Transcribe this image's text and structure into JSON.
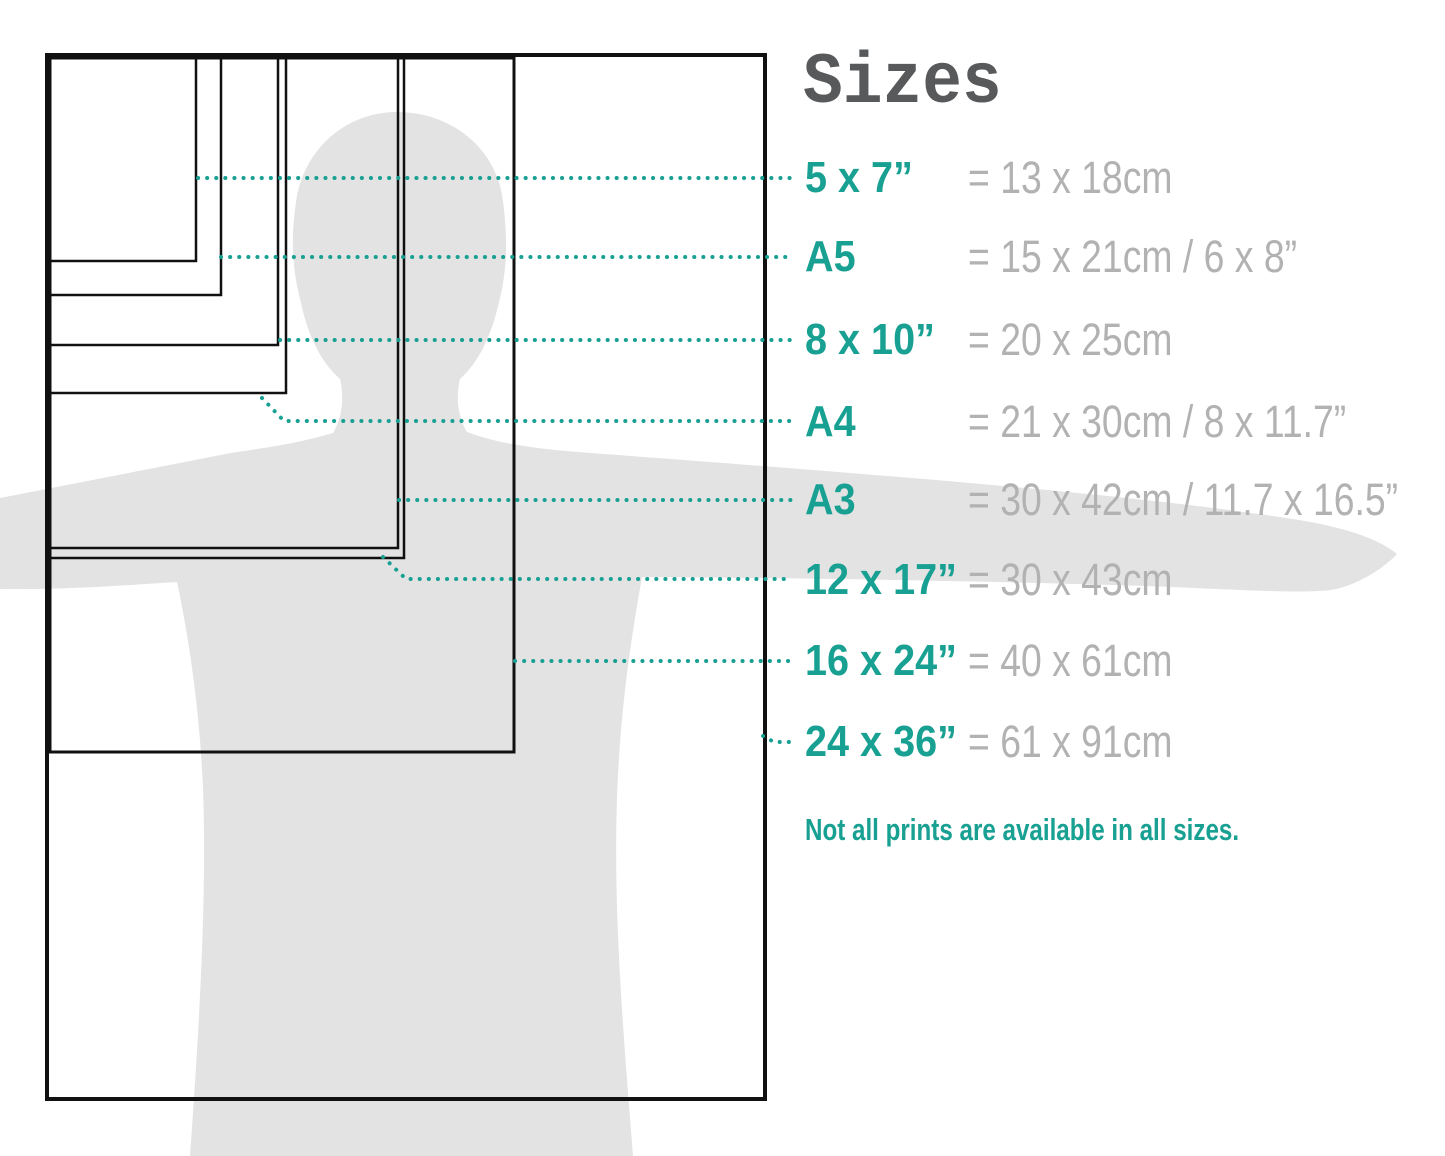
{
  "title": "Sizes",
  "note": "Not all prints are available in all sizes.",
  "colors": {
    "accent": "#18a092",
    "gray_text": "#b2b2b2",
    "title": "#58595b",
    "silhouette": "#e3e3e3",
    "border": "#111111"
  },
  "sizes": {
    "rows": [
      {
        "label": "5 x 7”",
        "metric": "= 13 x 18cm"
      },
      {
        "label": "A5",
        "metric": "= 15 x 21cm / 6 x 8”"
      },
      {
        "label": "8 x 10”",
        "metric": "= 20 x 25cm"
      },
      {
        "label": "A4",
        "metric": "= 21 x 30cm / 8 x 11.7”"
      },
      {
        "label": "A3",
        "metric": "= 30 x 42cm / 11.7 x 16.5”"
      },
      {
        "label": "12 x 17”",
        "metric": "= 30 x 43cm"
      },
      {
        "label": "16 x 24”",
        "metric": "= 40 x 61cm"
      },
      {
        "label": "24 x 36”",
        "metric": "= 61 x 91cm"
      }
    ]
  },
  "diagram": {
    "rects": [
      {
        "name": "24x36",
        "x": 47,
        "y": 55,
        "w": 718,
        "h": 1044,
        "sw": 4
      },
      {
        "name": "16x24",
        "x": 50,
        "y": 58,
        "w": 464,
        "h": 694,
        "sw": 3
      },
      {
        "name": "12x17",
        "x": 50,
        "y": 58,
        "w": 354,
        "h": 500,
        "sw": 2.5
      },
      {
        "name": "A3",
        "x": 50,
        "y": 58,
        "w": 348,
        "h": 490,
        "sw": 2.5
      },
      {
        "name": "A4",
        "x": 50,
        "y": 58,
        "w": 236,
        "h": 335,
        "sw": 2.5
      },
      {
        "name": "8x10",
        "x": 50,
        "y": 58,
        "w": 228,
        "h": 287,
        "sw": 2.5
      },
      {
        "name": "A5",
        "x": 50,
        "y": 58,
        "w": 171,
        "h": 237,
        "sw": 2.5
      },
      {
        "name": "5x7",
        "x": 50,
        "y": 58,
        "w": 146,
        "h": 203,
        "sw": 2.5
      }
    ],
    "callouts": [
      {
        "name": "5x7",
        "points": "198,178 792,178"
      },
      {
        "name": "A5",
        "points": "221,257 792,257"
      },
      {
        "name": "8x10",
        "points": "280,340 792,340"
      },
      {
        "name": "A4",
        "points": "262,398 284,421 792,421"
      },
      {
        "name": "A3",
        "points": "399,500 792,500"
      },
      {
        "name": "12x17",
        "points": "383,557 406,579 792,579"
      },
      {
        "name": "16x24",
        "points": "515,661 792,661"
      },
      {
        "name": "24x36",
        "points": "763,736 774,742 792,742"
      }
    ]
  }
}
